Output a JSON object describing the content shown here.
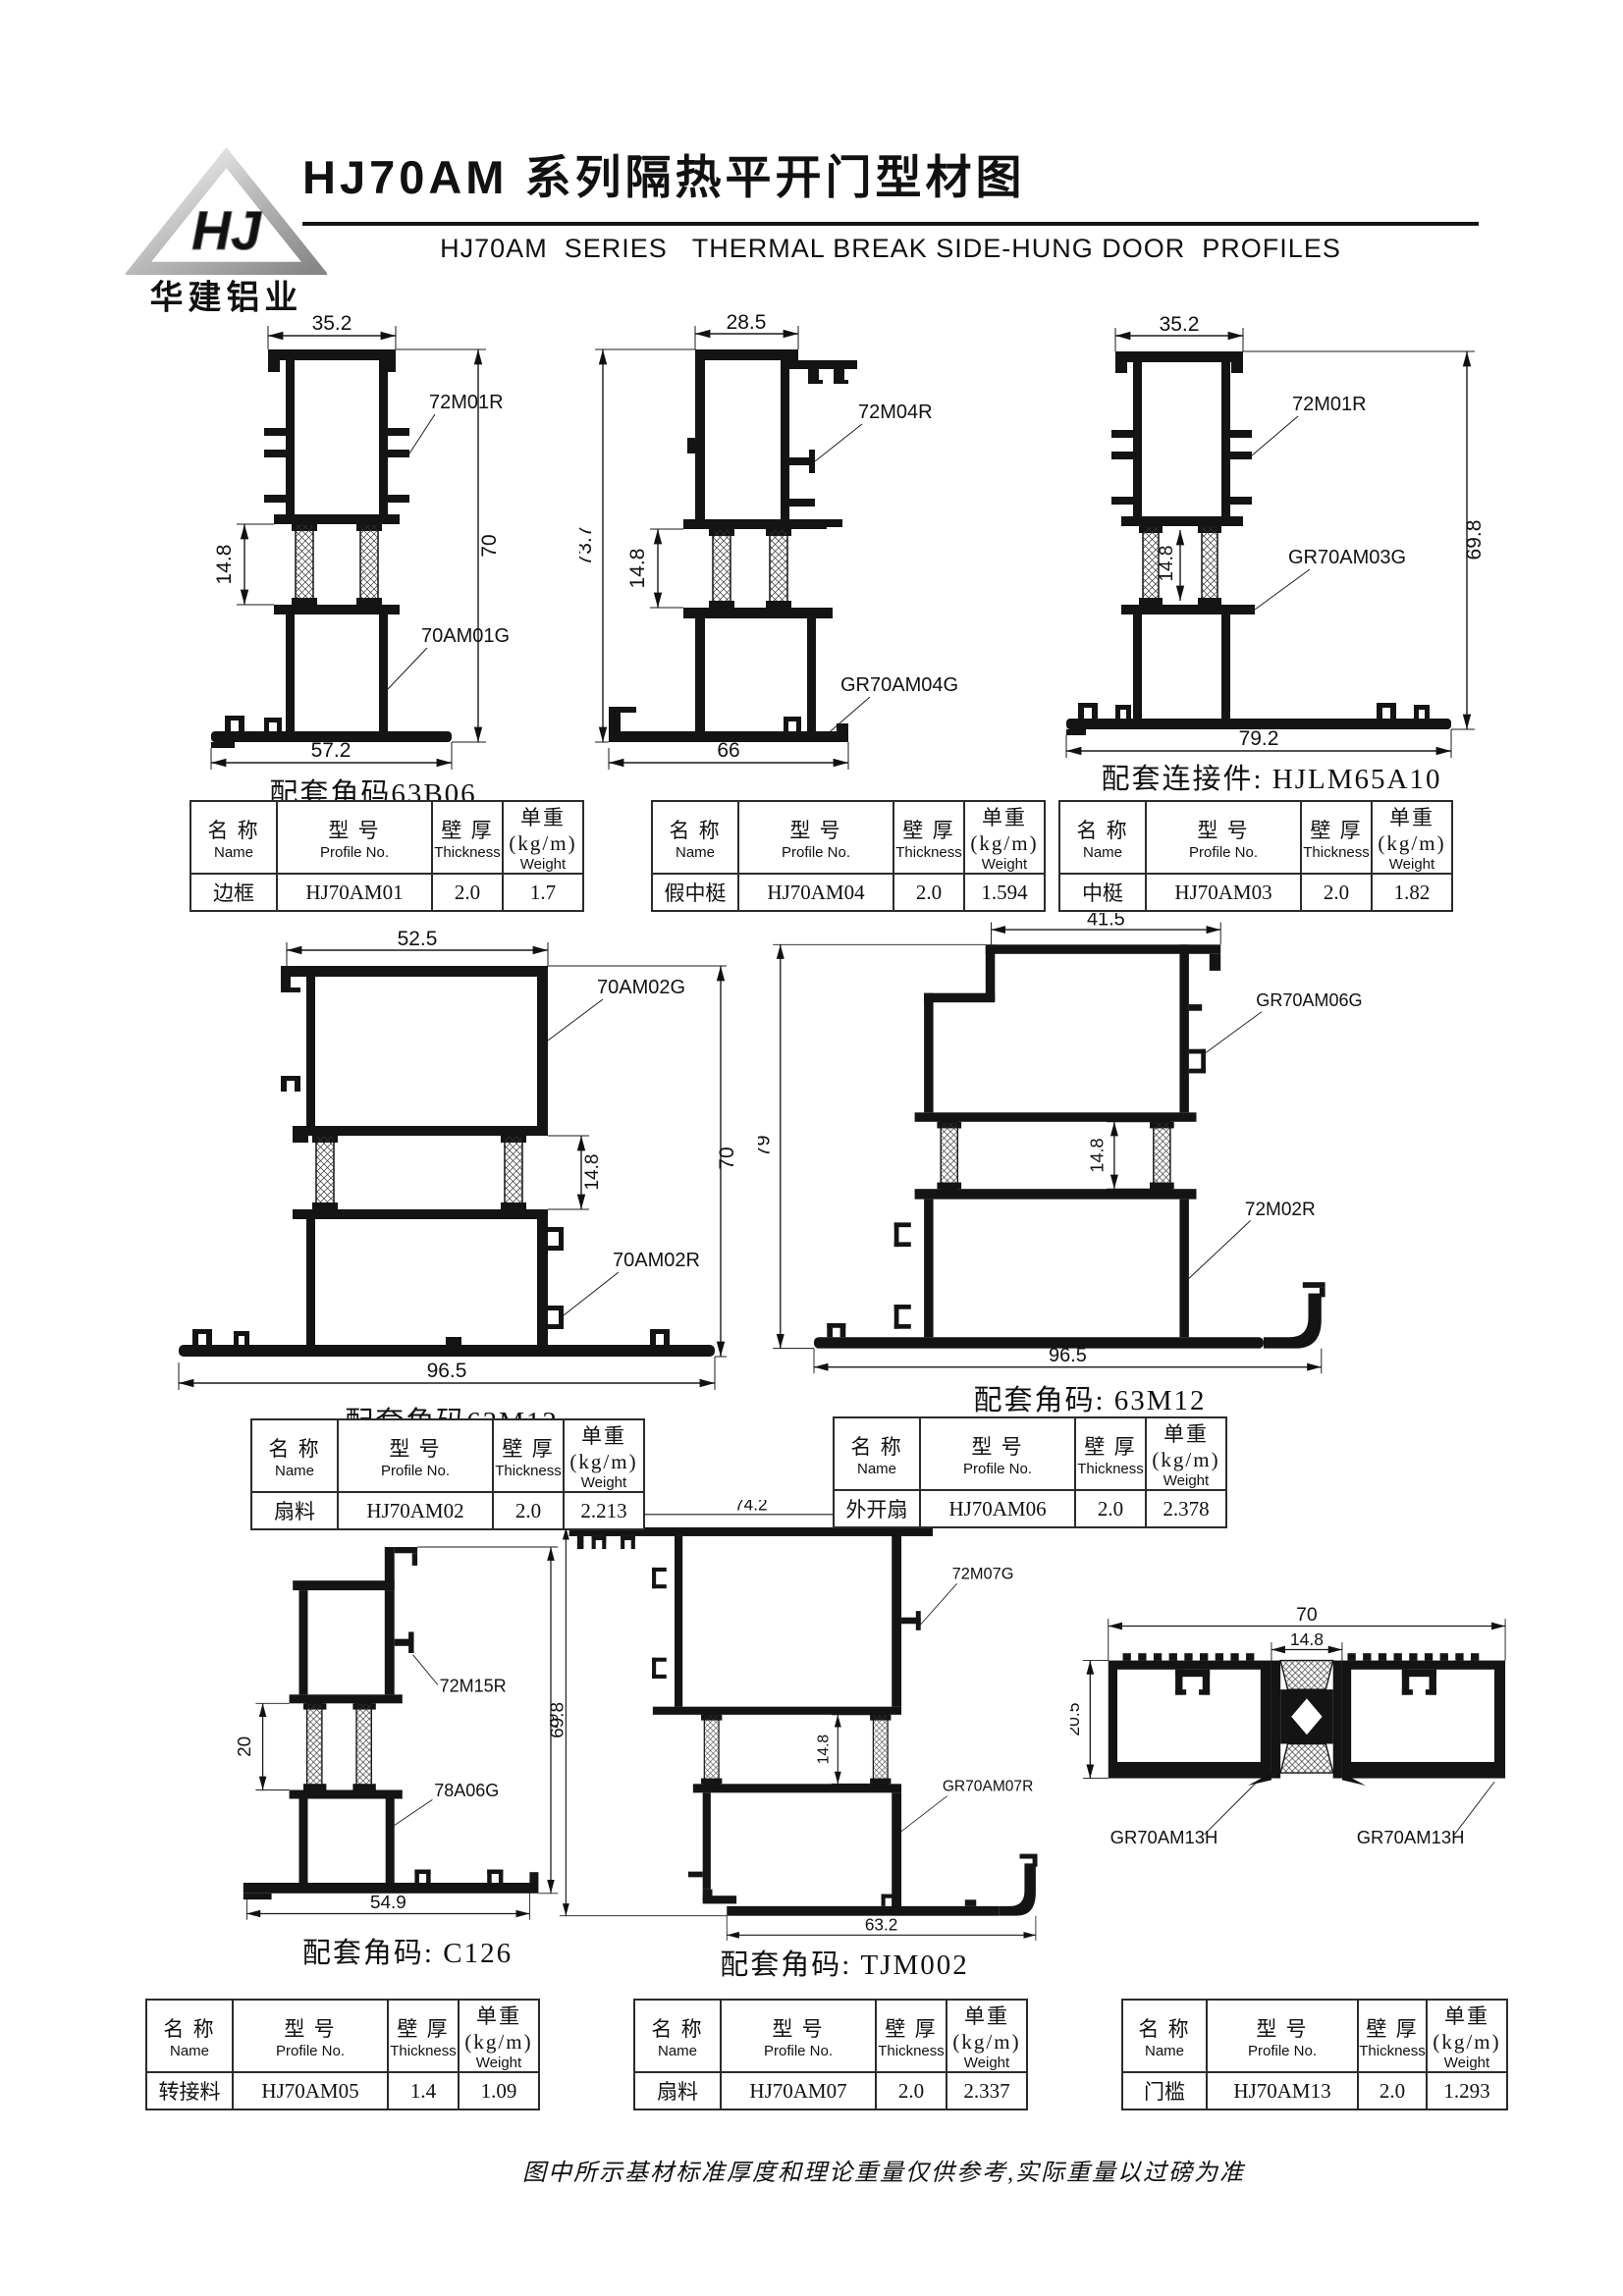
{
  "header": {
    "logo_monogram": "HJ",
    "logo_text": "华建铝业",
    "title": "HJ70AM 系列隔热平开门型材图",
    "subtitle": "HJ70AM  SERIES   THERMAL BREAK SIDE-HUNG DOOR  PROFILES"
  },
  "table_headers": {
    "name_cn": "名 称",
    "name_en": "Name",
    "profile_cn": "型 号",
    "profile_en": "Profile No.",
    "thickness_cn": "壁 厚",
    "thickness_en": "Thickness",
    "weight_cn": "单重(kg/m)",
    "weight_en": "Weight"
  },
  "drawings": [
    {
      "caption": "配套角码63B06",
      "dims": {
        "top": "35.2",
        "bottom": "57.2",
        "height": "70",
        "break": "14.8"
      },
      "labels": [
        "72M01R",
        "70AM01G"
      ],
      "profile": {
        "name": "边框",
        "no": "HJ70AM01",
        "thickness": "2.0",
        "weight": "1.7"
      }
    },
    {
      "caption": "",
      "dims": {
        "top": "28.5",
        "bottom": "66",
        "height": "73.7",
        "break": "14.8"
      },
      "labels": [
        "72M04R",
        "GR70AM04G"
      ],
      "profile": {
        "name": "假中梃",
        "no": "HJ70AM04",
        "thickness": "2.0",
        "weight": "1.594"
      }
    },
    {
      "caption": "配套连接件: HJLM65A10",
      "dims": {
        "top": "35.2",
        "bottom": "79.2",
        "height": "69.8",
        "break": "14.8"
      },
      "labels": [
        "72M01R",
        "GR70AM03G"
      ],
      "profile": {
        "name": "中梃",
        "no": "HJ70AM03",
        "thickness": "2.0",
        "weight": "1.82"
      }
    },
    {
      "caption": "配套角码63M12",
      "dims": {
        "top": "52.5",
        "bottom": "96.5",
        "height": "70",
        "break": "14.8"
      },
      "labels": [
        "70AM02G",
        "70AM02R"
      ],
      "profile": {
        "name": "扇料",
        "no": "HJ70AM02",
        "thickness": "2.0",
        "weight": "2.213"
      }
    },
    {
      "caption": "配套角码: 63M12",
      "dims": {
        "top": "41.5",
        "bottom": "96.5",
        "height": "79",
        "break": "14.8"
      },
      "labels": [
        "GR70AM06G",
        "72M02R"
      ],
      "profile": {
        "name": "外开扇",
        "no": "HJ70AM06",
        "thickness": "2.0",
        "weight": "2.378"
      }
    },
    {
      "caption": "配套角码: C126",
      "dims": {
        "bottom": "54.9",
        "height": "69.8",
        "break": "20"
      },
      "labels": [
        "72M15R",
        "78A06G"
      ],
      "profile": {
        "name": "转接料",
        "no": "HJ70AM05",
        "thickness": "1.4",
        "weight": "1.09"
      }
    },
    {
      "caption": "配套角码: TJM002",
      "dims": {
        "top": "74.2",
        "bottom": "63.2",
        "height": "79",
        "break": "14.8"
      },
      "labels": [
        "72M07G",
        "GR70AM07R"
      ],
      "profile": {
        "name": "扇料",
        "no": "HJ70AM07",
        "thickness": "2.0",
        "weight": "2.337"
      }
    },
    {
      "caption": "",
      "dims": {
        "top": "70",
        "break": "14.8",
        "height": "20.5"
      },
      "labels": [
        "GR70AM13H",
        "GR70AM13H"
      ],
      "profile": {
        "name": "门槛",
        "no": "HJ70AM13",
        "thickness": "2.0",
        "weight": "1.293"
      }
    }
  ],
  "footer": {
    "note": "图中所示基材标准厚度和理论重量仅供参考,实际重量以过磅为准"
  }
}
